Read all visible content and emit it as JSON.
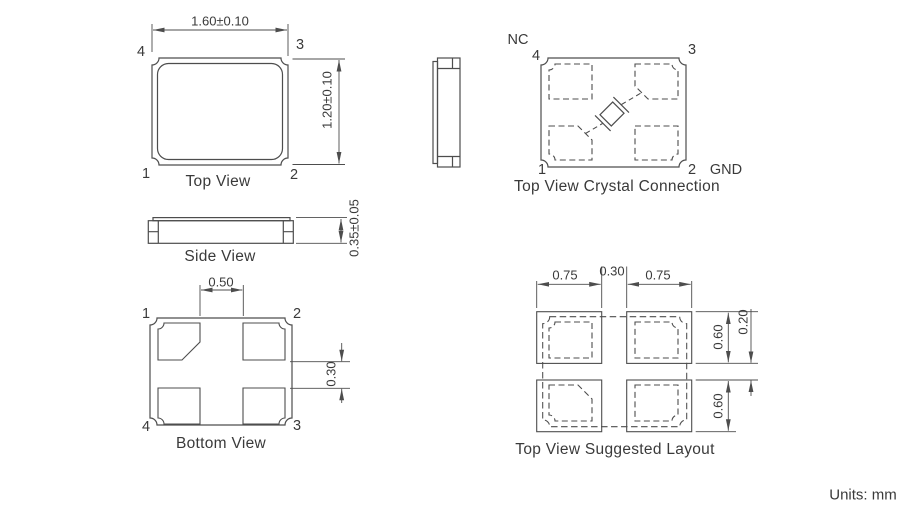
{
  "units_label": "Units: mm",
  "colors": {
    "line": "#4d4d4d",
    "text": "#3a3a3a",
    "background": "#ffffff"
  },
  "top_view": {
    "caption": "Top View",
    "dim_width": "1.60±0.10",
    "dim_height": "1.20±0.10",
    "pin_top_left": "4",
    "pin_top_right": "3",
    "pin_bottom_left": "1",
    "pin_bottom_right": "2"
  },
  "side_view": {
    "caption": "Side View",
    "dim_thickness": "0.35±0.05"
  },
  "crystal_connection_view": {
    "caption": "Top View Crystal Connection",
    "label_nc": "NC",
    "label_gnd": "GND",
    "pin_top_left": "4",
    "pin_top_right": "3",
    "pin_bottom_left": "1",
    "pin_bottom_right": "2"
  },
  "bottom_view": {
    "caption": "Bottom View",
    "dim_center_gap": "0.50",
    "dim_row_gap": "0.30",
    "pin_top_left": "1",
    "pin_top_right": "2",
    "pin_bottom_left": "4",
    "pin_bottom_right": "3"
  },
  "suggested_layout_view": {
    "caption": "Top View Suggested Layout",
    "dim_pad_width_left": "0.75",
    "dim_center_gap": "0.30",
    "dim_pad_width_right": "0.75",
    "dim_pad_height_top": "0.60",
    "dim_row_gap": "0.20",
    "dim_pad_height_bottom": "0.60"
  }
}
